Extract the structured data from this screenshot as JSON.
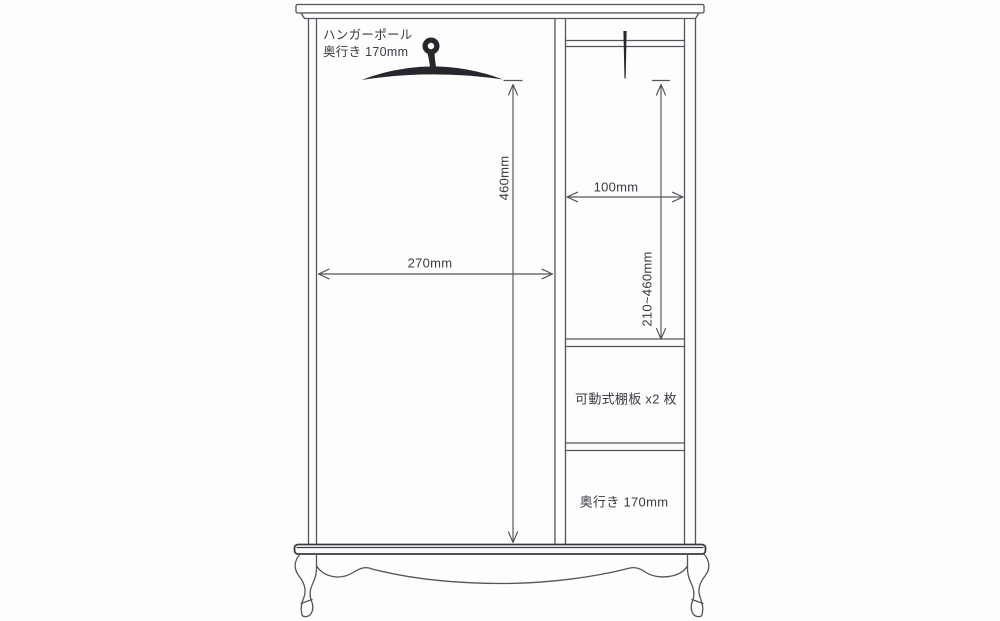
{
  "figure": {
    "kind": "wardrobe-dimension-diagram",
    "background": "#fdfdfd",
    "line_color": "#54545c",
    "board_color": "#3a3a42",
    "ink_color": "#26262c",
    "text_color": "#3b3b44"
  },
  "annotations": {
    "hanger_note_line1": "ハンガーポール",
    "hanger_note_line2": "奥行き 170mm",
    "dim_left_height": "460mm",
    "dim_left_width": "270mm",
    "dim_right_width": "100mm",
    "dim_right_height_range": "210~460mm",
    "shelf_note": "可動式棚板 x2 枚",
    "depth_note": "奥行き 170mm"
  }
}
